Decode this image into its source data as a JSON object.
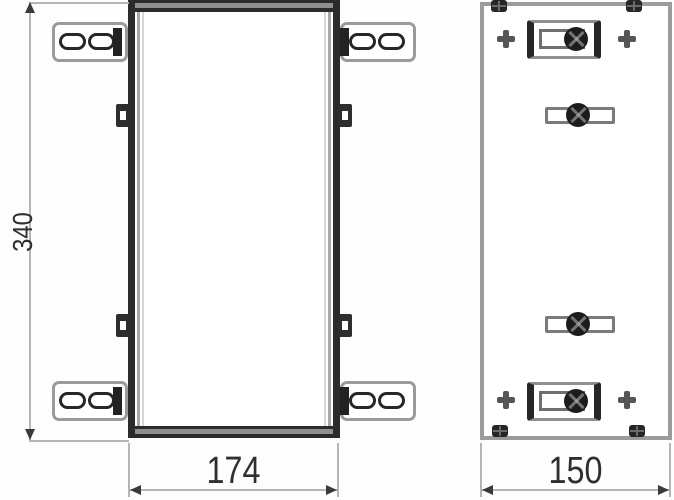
{
  "dimensions": {
    "front_height": "340",
    "front_width": "174",
    "side_width": "150"
  },
  "colors": {
    "line_dark": "#2b2b2b",
    "line_medium": "#9b9b9b",
    "line_light": "#b5b5b5",
    "screw_dark": "#1c1c1c",
    "text": "#2f2f2f",
    "background": "#fdfdfd"
  }
}
